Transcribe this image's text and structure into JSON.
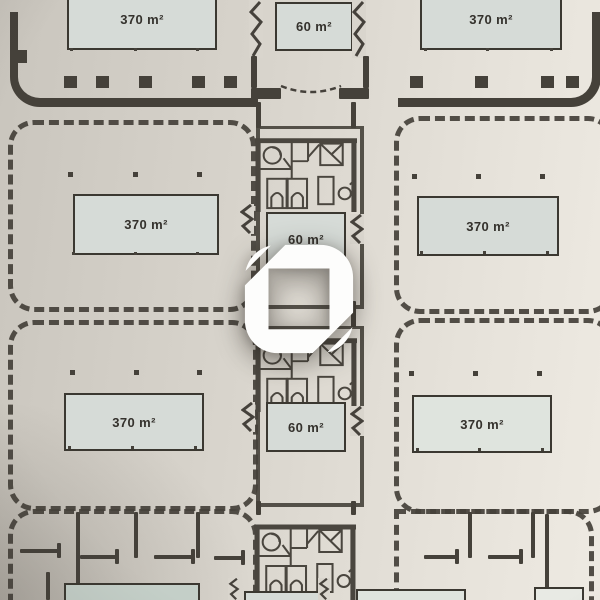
{
  "floors": [
    {
      "rooms": {
        "left": "370 m²",
        "core": "60 m²",
        "right": "370 m²"
      }
    },
    {
      "rooms": {
        "left": "370 m²",
        "core": "60 m²",
        "right": "370 m²"
      }
    },
    {
      "rooms": {
        "left": "370 m²",
        "core": "60 m²",
        "right": "370 m²"
      }
    }
  ],
  "colors": {
    "ink": "#45413a",
    "ink2": "#3b3831",
    "paper_light": "#eeeae2",
    "paper_dark": "#c9c5bd",
    "label_fill": "#d6dbd7",
    "label_fill_green": "#c4cfc8",
    "label_fill_faint": "#dfe4de",
    "watermark": "#fdfdfc"
  }
}
